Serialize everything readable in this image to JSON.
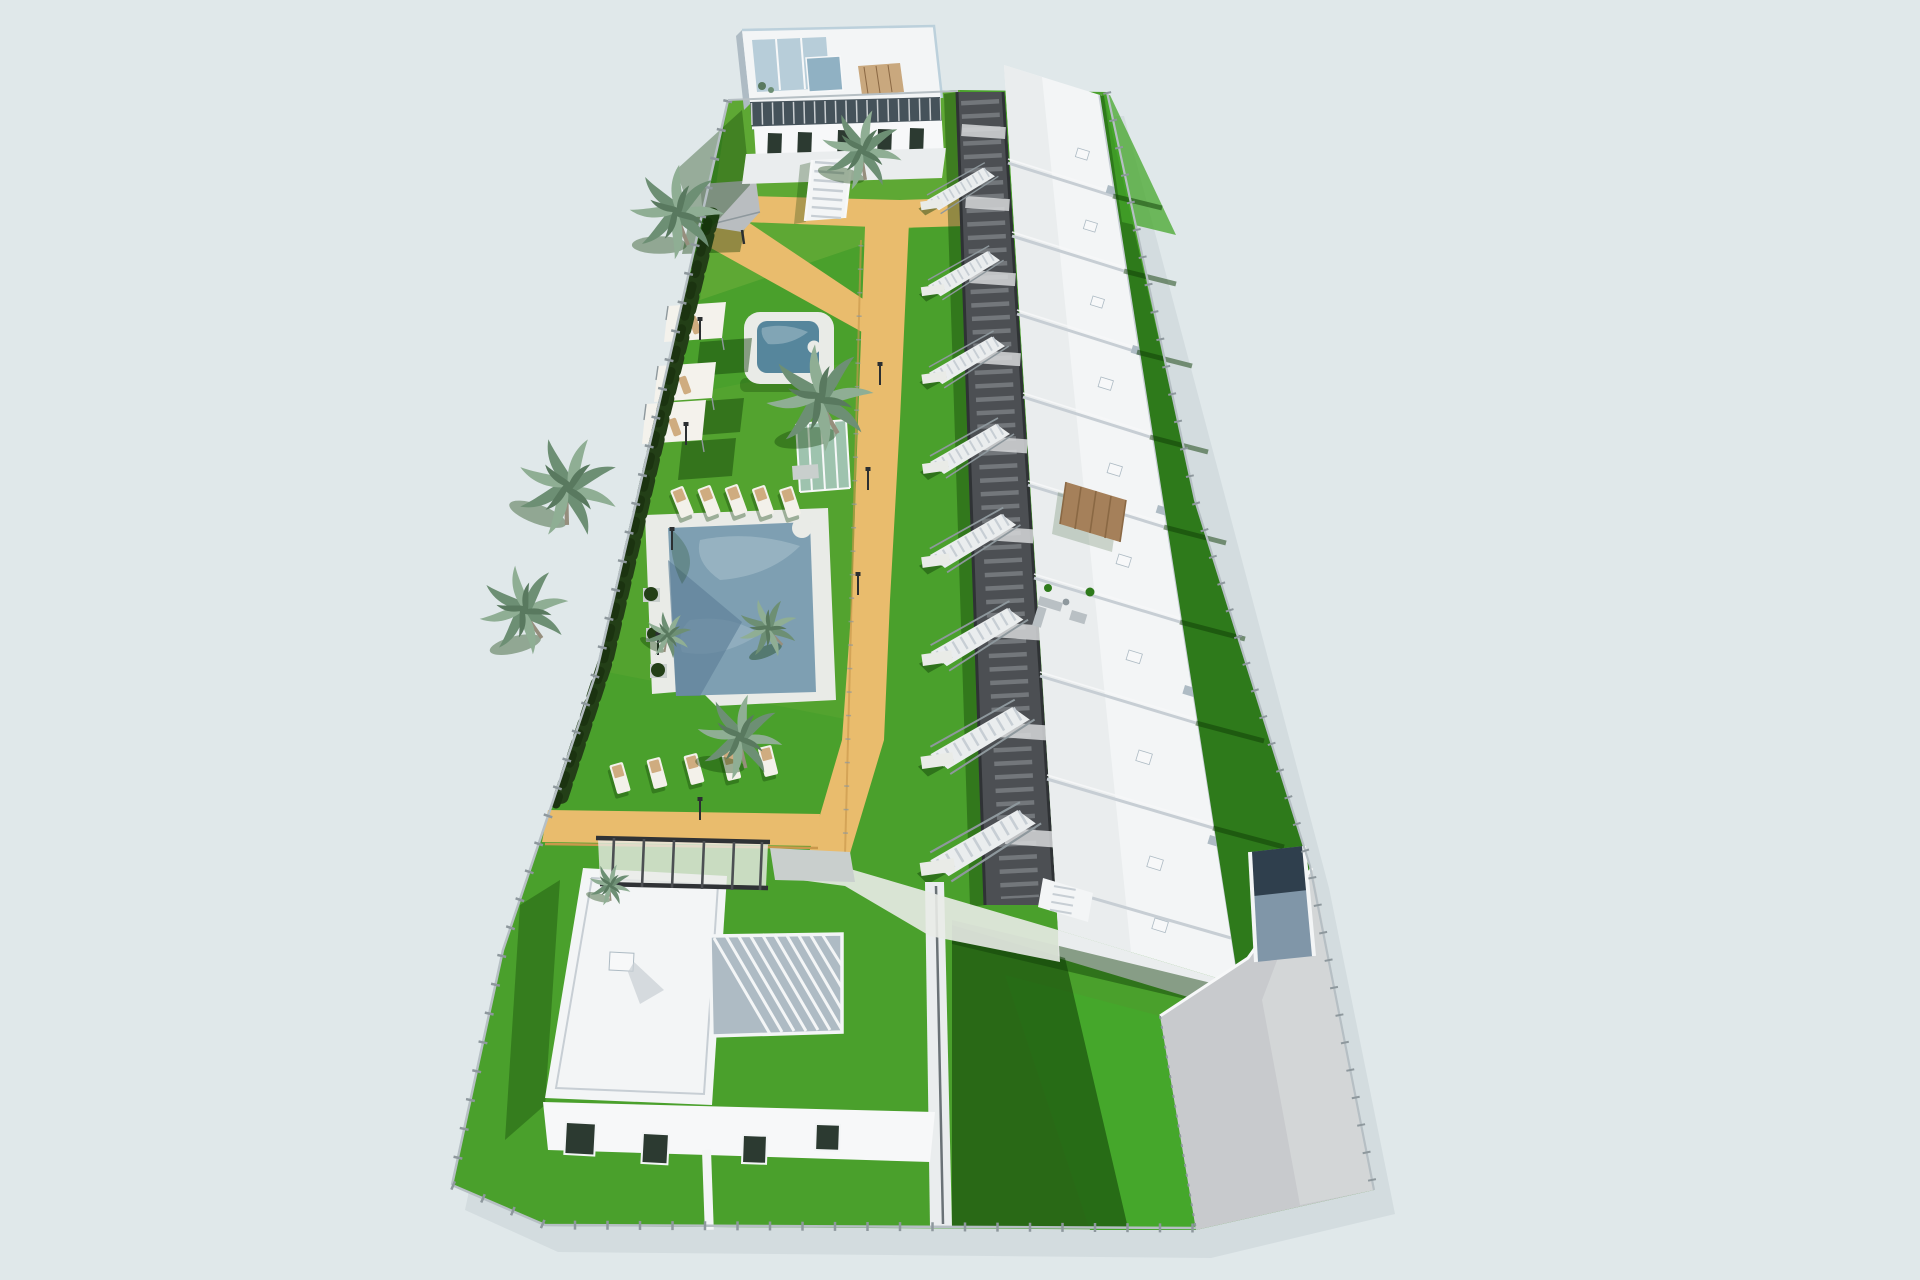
{
  "scene": {
    "type": "architectural-3d-render",
    "view": "aerial-perspective",
    "subject": "residential development with townhouse row, communal pools, gardens and detached villa",
    "colors": {
      "bg": "#e0e8ea",
      "site_shadow": "#b9c6cc",
      "lawn_main": "#4aa02c",
      "lawn_top": "#6cad3a",
      "lawn_bright": "#45a72b",
      "lawn_dark": "#2e7a1b",
      "shadow_green": "#0f3c06",
      "hedge": "#233f17",
      "cypress": "#1b3310",
      "sand": "#e9bc6d",
      "sand_edge": "#c9984c",
      "deck": "#e9ebe7",
      "deck_shadow": "#c9cfcd",
      "water_light": "#a6bfcb",
      "water_main": "#7e9fb2",
      "water_deep": "#5d8098",
      "water_kids": "#56869c",
      "white_roof": "#f3f5f6",
      "white_terrace": "#eaedee",
      "white_wall": "#f7f8f9",
      "wall_shade": "#c7ced4",
      "wall_dark_shade": "#aebbc4",
      "glass_dark": "#2c3a31",
      "glass_blue": "#b7cdd9",
      "glass_stair": "#90b1c3",
      "band_dark": "#45525a",
      "walkway": "#4c4f53",
      "walkway_beam": "#73777b",
      "walkway_dark": "#2f3235",
      "wood": "#a5805a",
      "wood_dark": "#8a6844",
      "wood_deck": "#c9a87e",
      "ramp_top": "#2f3f4d",
      "ramp_bottom": "#8096a8",
      "drive": "#c8cacd",
      "drive_light": "#d6d8da",
      "fence": "#b6bfc4",
      "fence_post": "#8e989d",
      "palm_light": "#8fae94",
      "palm_mid": "#6d8f74",
      "palm_dark": "#59795f",
      "trunk": "#968e7d",
      "lounger": "#f3f1ea",
      "lounger_cushion": "#cfac80",
      "lounger_gray": "#b9c0c4",
      "sail": "#f4f2ec",
      "gazebo": "#b9bdc0",
      "lamp": "#2b2f31",
      "divider": "#6a7276"
    },
    "elements": {
      "top_apartment_building": {
        "count": 1
      },
      "townhouse_row_units": {
        "count": 10
      },
      "central_walkway": {
        "count": 1
      },
      "exterior_staircases": {
        "count": 9
      },
      "main_pool": {
        "count": 1
      },
      "kids_pool": {
        "count": 1
      },
      "pool_glass_enclosure": {
        "count": 1
      },
      "sun_loungers": {
        "count": 10
      },
      "shade_sails": {
        "count": 3
      },
      "corner_gazebo": {
        "count": 1
      },
      "palm_trees": {
        "count": 9
      },
      "detached_villa": {
        "count": 1
      },
      "wood_roof_pergola": {
        "count": 1
      },
      "slatted_roof_pergola": {
        "count": 1
      },
      "charcoal_patio_pergola": {
        "count": 1
      },
      "garage_ramp": {
        "count": 1
      },
      "driveway": {
        "count": 1
      },
      "perimeter_fence": {
        "count": 1
      },
      "garden_lamps": {
        "count": 8
      }
    }
  }
}
